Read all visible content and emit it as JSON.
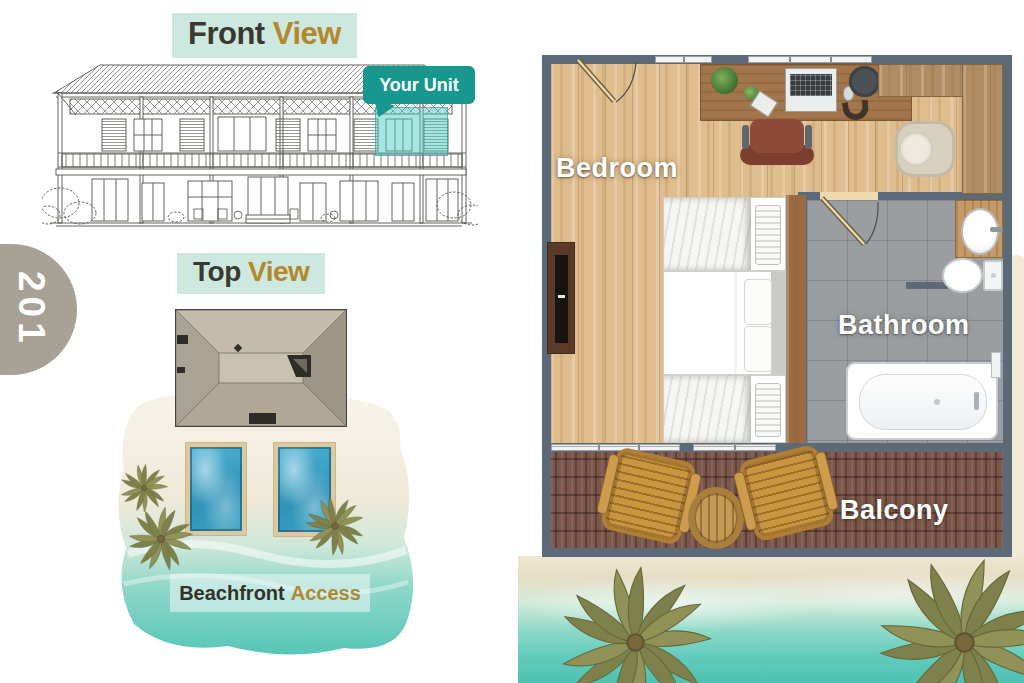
{
  "unit_badge": {
    "number": "201"
  },
  "front_view": {
    "title": {
      "primary": "Front",
      "accent": "View"
    },
    "callout": "Your Unit"
  },
  "top_view": {
    "title": {
      "primary": "Top",
      "accent": "View"
    },
    "caption": {
      "primary": "Beachfront",
      "accent": "Access"
    }
  },
  "floor_plan": {
    "bedroom_label": "Bedroom",
    "bathroom_label": "Bathroom",
    "balcony_label": "Balcony"
  },
  "colors": {
    "accent_teal": "#17988f",
    "accent_gold": "#b3872c",
    "title_bg_mint": "#cde9df",
    "badge_gray": "#a7a295",
    "wall_slate": "#5c6a77",
    "pool_blue": "#2f93b8",
    "water_turquoise": "#5ecabb"
  }
}
